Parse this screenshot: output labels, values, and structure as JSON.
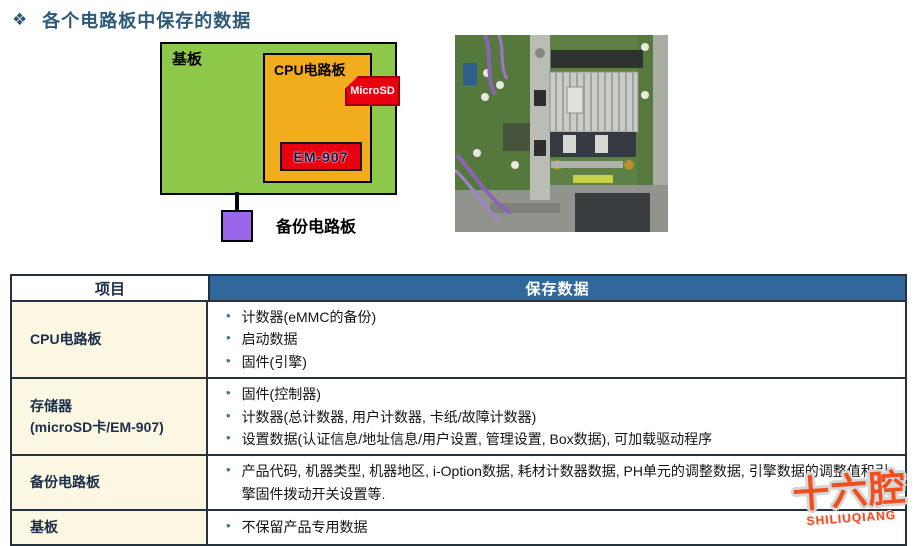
{
  "title": {
    "icon": "❖",
    "text": "各个电路板中保存的数据",
    "color": "#2d5a78"
  },
  "diagram": {
    "base_board_label": "基板",
    "cpu_board_label": "CPU电路板",
    "microsd_tag": "MicroSD",
    "em907_tag": "EM-907",
    "backup_board_label": "备份电路板",
    "colors": {
      "base_board": "#8dc84a",
      "cpu_board": "#f2ad1c",
      "tag_red": "#e8000f",
      "backup_board": "#9a67ea"
    }
  },
  "table": {
    "bullet_glyph": "•",
    "header": {
      "item": "项目",
      "data": "保存数据"
    },
    "header_bg": "#30689b",
    "item_col_bg": "#fcf7e2",
    "rows": [
      {
        "item": "CPU电路板",
        "points": [
          "计数器(eMMC的备份)",
          "启动数据",
          "固件(引擎)"
        ]
      },
      {
        "item": "存储器",
        "item_sub": "(microSD卡/EM-907)",
        "points": [
          "固件(控制器)",
          "计数器(总计数器, 用户计数器, 卡纸/故障计数器)",
          "设置数据(认证信息/地址信息/用户设置, 管理设置, Box数据), 可加载驱动程序"
        ]
      },
      {
        "item": "备份电路板",
        "points": [
          "产品代码, 机器类型, 机器地区, i-Option数据, 耗材计数器数据, PH单元的调整数据, 引擎数据的调整值和引擎固件拨动开关设置等."
        ]
      },
      {
        "item": "基板",
        "points": [
          "不保留产品专用数据"
        ]
      }
    ]
  },
  "watermark": {
    "text": "十六腔",
    "subtext": "SHILIUQIANG",
    "color": "#f04e1e"
  }
}
